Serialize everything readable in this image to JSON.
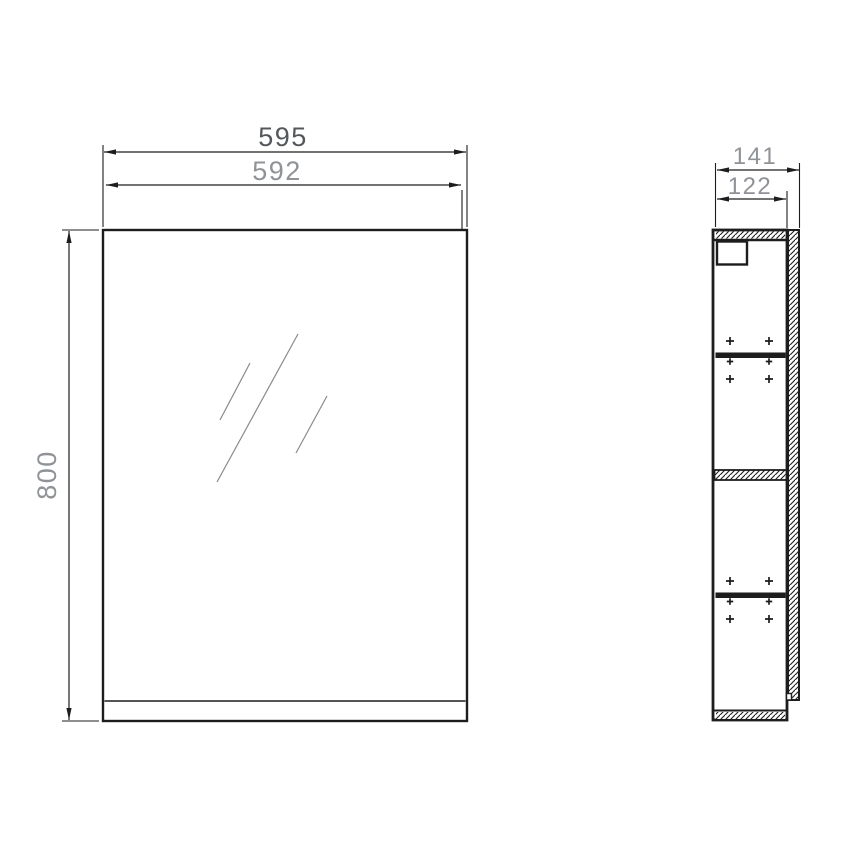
{
  "drawing": {
    "type": "technical-drawing",
    "subject": "mirror-cabinet",
    "views": {
      "front": "front-view-mirror-door",
      "side": "side-section-view"
    }
  },
  "dimensions": {
    "front_width_total": "595",
    "front_width_door": "592",
    "front_height": "800",
    "side_depth_total": "141",
    "side_depth_body": "122"
  },
  "colors": {
    "line": "#1d1d1d",
    "dim_text_primary": "#54585c",
    "dim_text_secondary": "#8f9397",
    "mirror_line": "#8a8a8a",
    "background": "#ffffff"
  }
}
